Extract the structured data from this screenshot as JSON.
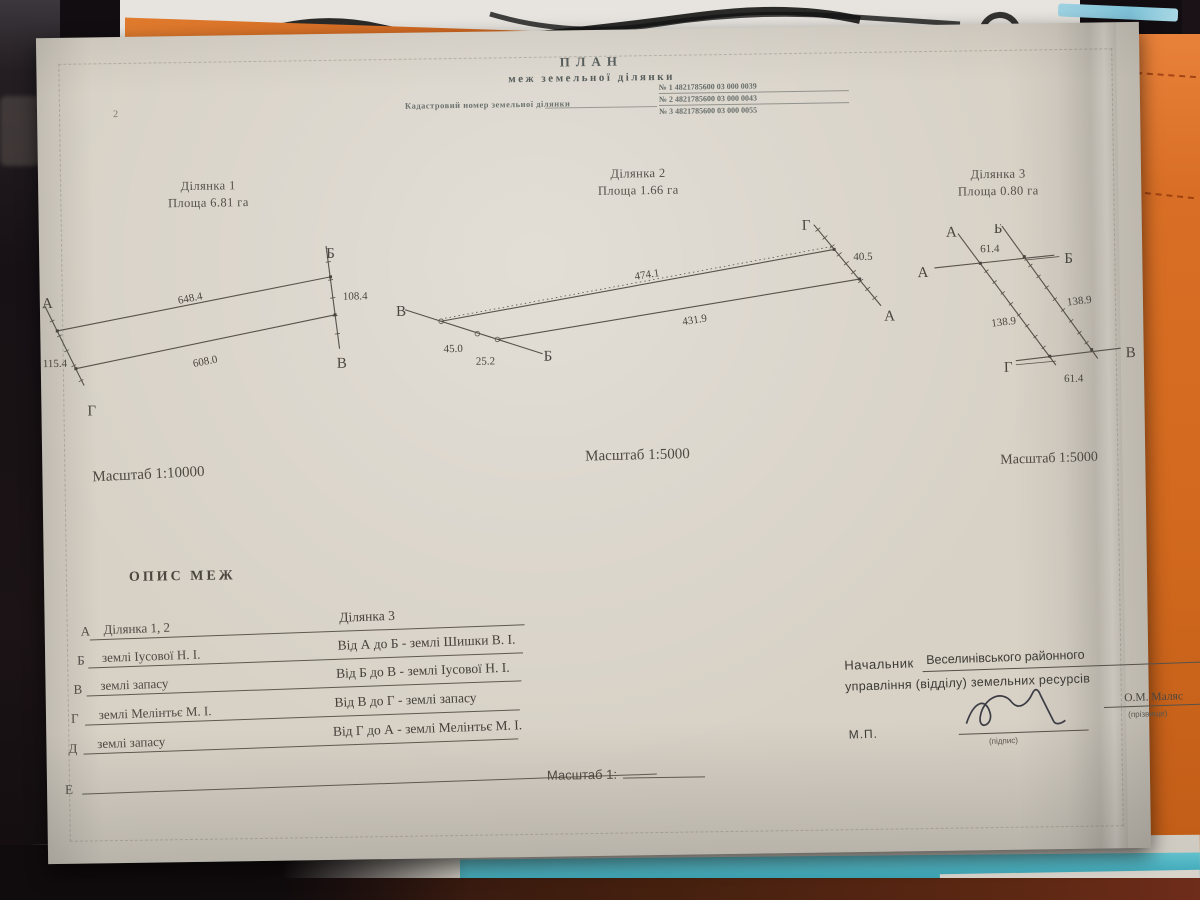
{
  "page_number": "2",
  "header": {
    "title": "ПЛАН",
    "subtitle": "меж земельної ділянки",
    "cadastral_label": "Кадастровий номер земельної ділянки",
    "cadastral_numbers": [
      "№ 1  4821785600 03 000 0039",
      "№ 2  4821785600 03 000 0043",
      "№ 3  4821785600 03 000 0055"
    ]
  },
  "parcels": [
    {
      "name": "Ділянка 1",
      "area": "Площа 6.81 га",
      "scale": "Масштаб 1:10000",
      "corners": {
        "a": "А",
        "b": "Б",
        "v": "В",
        "g": "Г"
      },
      "sides": {
        "top": "648.4",
        "right": "108.4",
        "bottom": "608.0",
        "left": "115.4"
      }
    },
    {
      "name": "Ділянка 2",
      "area": "Площа 1.66 га",
      "scale": "Масштаб 1:5000",
      "corners": {
        "left": "В",
        "bottom": "Б",
        "top_right": "Г",
        "right": "А"
      },
      "sides": {
        "top": "474.1",
        "bottom": "431.9",
        "seg_a": "45.0",
        "seg_b": "25.2",
        "right": "40.5"
      }
    },
    {
      "name": "Ділянка 3",
      "area": "Площа 0.80 га",
      "scale": "Масштаб 1:5000",
      "corners": {
        "top_a": "А",
        "top_b": "Б",
        "left_a": "А",
        "right_b": "Б",
        "bottom_g": "Г",
        "bottom_v": "В"
      },
      "sides": {
        "top": "61.4",
        "right": "138.9",
        "left": "138.9",
        "bottom": "61.4"
      }
    }
  ],
  "description": {
    "heading": "ОПИС МЕЖ",
    "rows": [
      {
        "letter": "А",
        "col1": "Ділянка 1, 2",
        "col2": "Ділянка 3"
      },
      {
        "letter": "Б",
        "col1": "землі Іусової Н. І.",
        "col2": "Від А до Б - землі Шишки В. І."
      },
      {
        "letter": "В",
        "col1": "землі запасу",
        "col2": "Від Б до В - землі Іусової Н. І."
      },
      {
        "letter": "Г",
        "col1": "землі Мелінтьє М. І.",
        "col2": "Від В до Г - землі запасу"
      },
      {
        "letter": "Д",
        "col1": "землі запасу",
        "col2": "Від Г до А - землі Мелінтьє М. І."
      },
      {
        "letter": "Е",
        "col1": "",
        "col2": ""
      }
    ],
    "scale_blank_label": "Масштаб  1:"
  },
  "official": {
    "role": "Начальник",
    "org_line1": "Веселинівського районного",
    "org_line2": "управління (відділу) земельних ресурсів",
    "seal": "М.П.",
    "sign_caption": "(підпис)",
    "surname": "О.М. Маляс",
    "surname_caption": "(прізвище)"
  },
  "photo_colors": {
    "paper": "#d7d1c6",
    "orange_folder": "#d2691e",
    "teal_sheet": "#46adbc",
    "backdrop": "#171114",
    "ink": "#4a463f"
  }
}
